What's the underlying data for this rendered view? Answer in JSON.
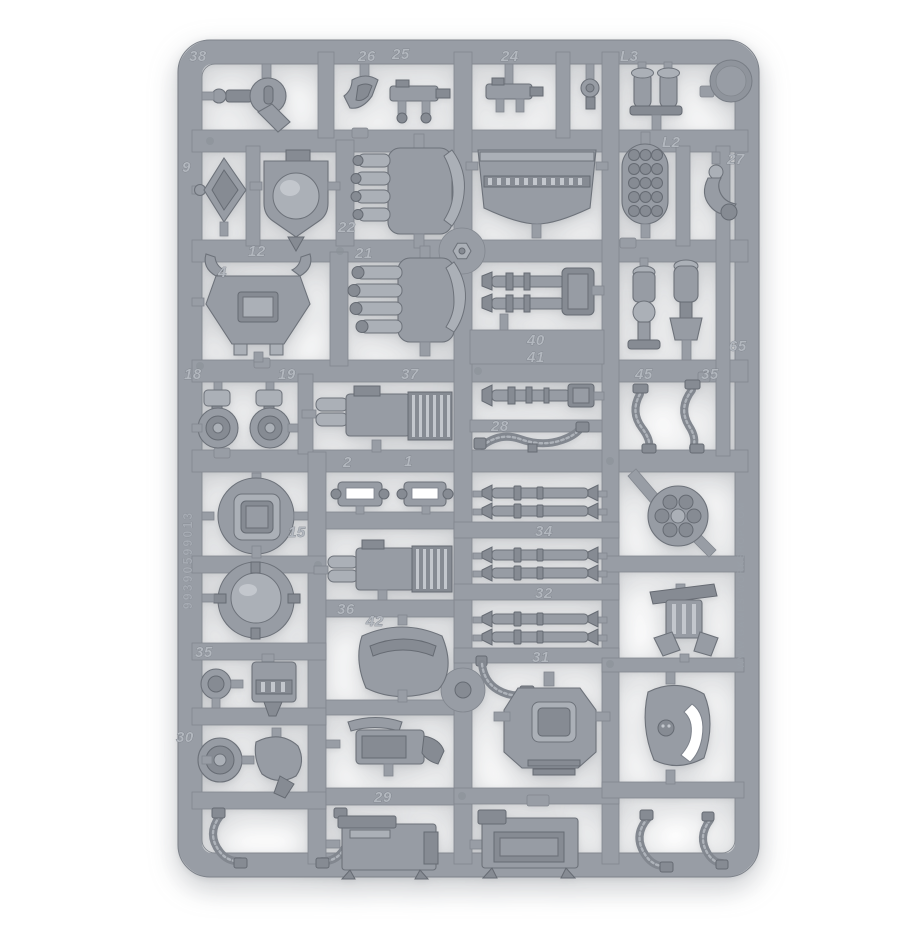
{
  "image": {
    "type": "product-photo",
    "subject": "Grey plastic miniature model sprue with weapon, armour and engine parts on white background",
    "background_color": "#ffffff",
    "plastic_color": "#979ca4",
    "plastic_shadow_color": "#71767e",
    "plastic_highlight_color": "#adb2b9"
  },
  "sprue": {
    "part_labels": [
      "38",
      "26",
      "25",
      "24",
      "L3",
      "L2",
      "27",
      "9",
      "12",
      "22",
      "21",
      "4",
      "40",
      "41",
      "65",
      "18",
      "19",
      "37",
      "45",
      "35",
      "2",
      "1",
      "28",
      "15",
      "34",
      "32",
      "31",
      "36",
      "42",
      "35",
      "30",
      "29"
    ],
    "product_code": "99390599013",
    "edge_text": "WWW.GAMES-WORKSHOP.COM"
  }
}
